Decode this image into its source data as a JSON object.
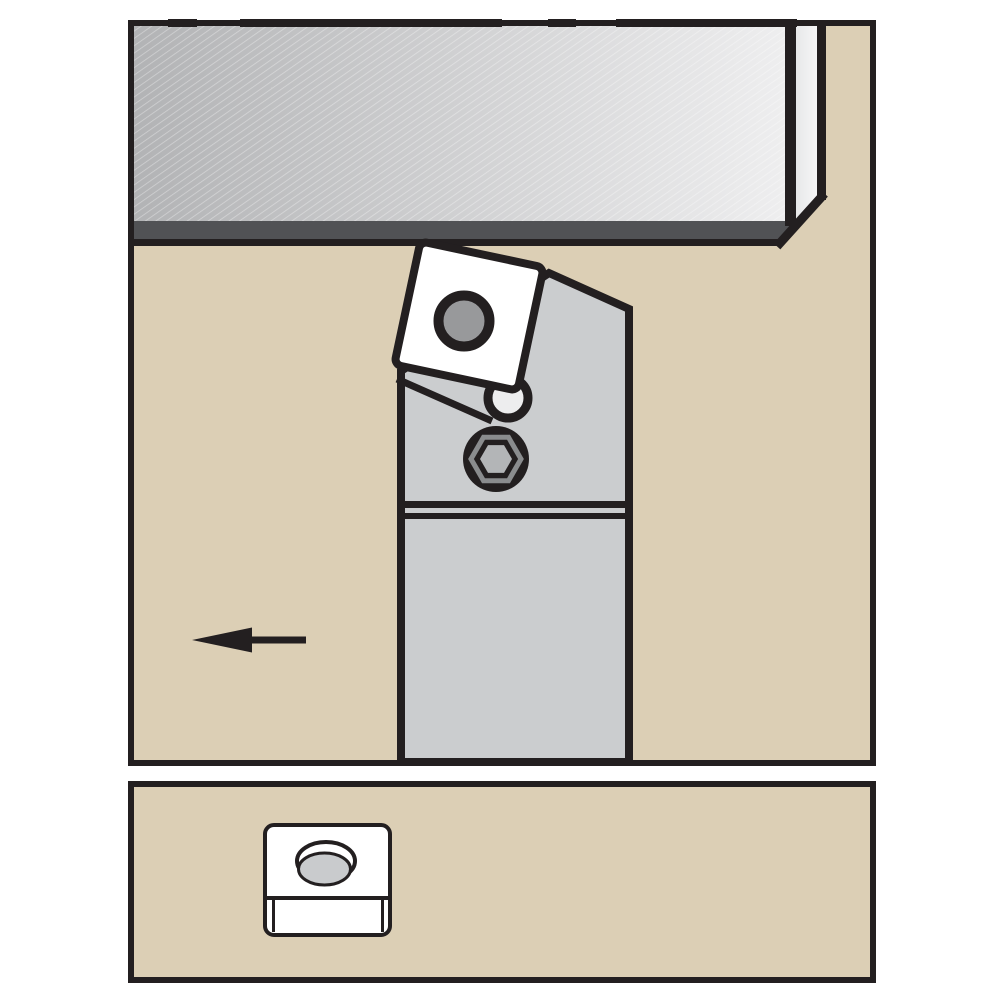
{
  "page": {
    "title": ""
  },
  "figure": {
    "kind": "technical-illustration",
    "main_view": {
      "workpiece": "gray hatched bar with beveled right end and dark machined edge strip",
      "tool": "turning tool holder (gray shank) with rotated square insert clamped on top",
      "insert_hole": "round center hole in square insert",
      "clamp_hole": "small round washer/hole at insert corner",
      "screw": "hex socket head clamp screw",
      "feed_arrow_direction": "left",
      "shim_lines": "double horizontal seat lines across holder shank"
    },
    "detail_view": {
      "part": "square indexable insert, top-front view",
      "hole": "countersunk oval center hole"
    }
  },
  "colors": {
    "page_bg": "#ffffff",
    "panel_bg": "#dccfb5",
    "outline": "#231f20",
    "holder": "#cbcdcf",
    "insert": "#ffffff",
    "insert_hole": "#98999b",
    "washer_fill": "#ededee",
    "workpiece_left": "#b2b3b5",
    "workpiece_right": "#eeeeef",
    "workpiece_strip": "#515255",
    "hex_ring": "#8a8c8e",
    "hex_center": "#b3b5b7",
    "detail_hole": "#c9cbcd"
  }
}
